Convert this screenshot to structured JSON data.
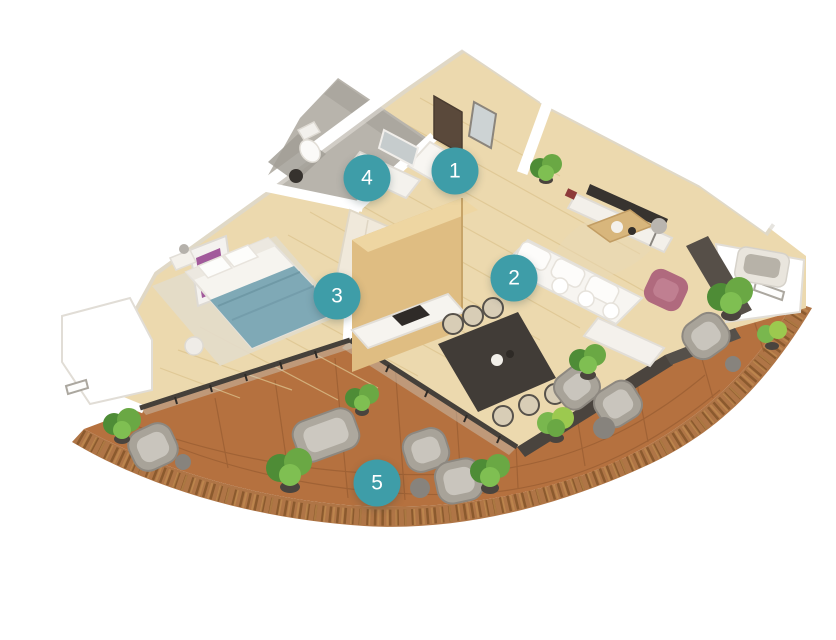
{
  "scene": {
    "kind": "3d-apartment-floor-plan",
    "background": "#FFFFFF",
    "view": "isometric-top"
  },
  "markers": [
    {
      "number": "1",
      "area": "entrance-hall",
      "x_pct": 54.4,
      "y_pct": 26.7
    },
    {
      "number": "2",
      "area": "living-dining",
      "x_pct": 61.5,
      "y_pct": 43.4
    },
    {
      "number": "3",
      "area": "bedroom",
      "x_pct": 40.3,
      "y_pct": 46.3
    },
    {
      "number": "4",
      "area": "bathroom",
      "x_pct": 43.9,
      "y_pct": 27.8
    },
    {
      "number": "5",
      "area": "balcony-terrace",
      "x_pct": 45.1,
      "y_pct": 75.5
    }
  ],
  "marker_style": {
    "fill": "#3E9DA8",
    "text_color": "#FFFFFF",
    "diameter_px": 47
  },
  "palette": {
    "wall": "#FFFFFF",
    "wall_shadow": "#DCD8D1",
    "wood_floor": "#ECD9AE",
    "wood_plank_line": "#DDC48F",
    "partition_wood": "#DFBD82",
    "bathroom_tile": "#B8B4AC",
    "balcony_tile": "#B5713F",
    "balcony_rim_wood": "#AF7546",
    "glass_frame": "#45403A",
    "bed_duvet": "#7FA9B6",
    "armchair_pink": "#B06A7E",
    "plant_green": "#5F9C3F",
    "wicker_gray": "#AFAAA0",
    "dark_furniture": "#413C37"
  }
}
